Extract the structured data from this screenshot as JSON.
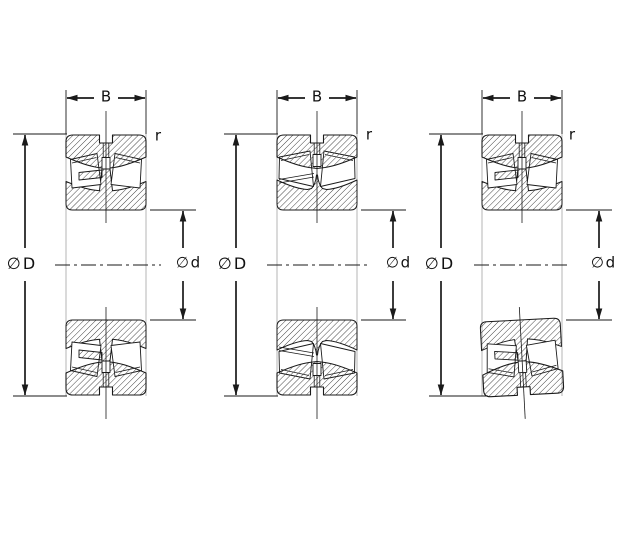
{
  "diagram": {
    "background_color": "#ffffff",
    "line_color": "#1a1a1a",
    "face_line_color": "#b5b5b5",
    "hatch_color": "#333333",
    "views": [
      {
        "id": "bearing-view-1",
        "labels": {
          "width": "B",
          "corner_radius": "r",
          "outer_diameter": "∅ D",
          "bore_diameter": "∅ d"
        }
      },
      {
        "id": "bearing-view-2",
        "labels": {
          "width": "B",
          "corner_radius": "r",
          "outer_diameter": "∅ D",
          "bore_diameter": "∅ d"
        }
      },
      {
        "id": "bearing-view-3",
        "labels": {
          "width": "B",
          "corner_radius": "r",
          "outer_diameter": "∅ D",
          "bore_diameter": "∅ d"
        }
      }
    ]
  }
}
